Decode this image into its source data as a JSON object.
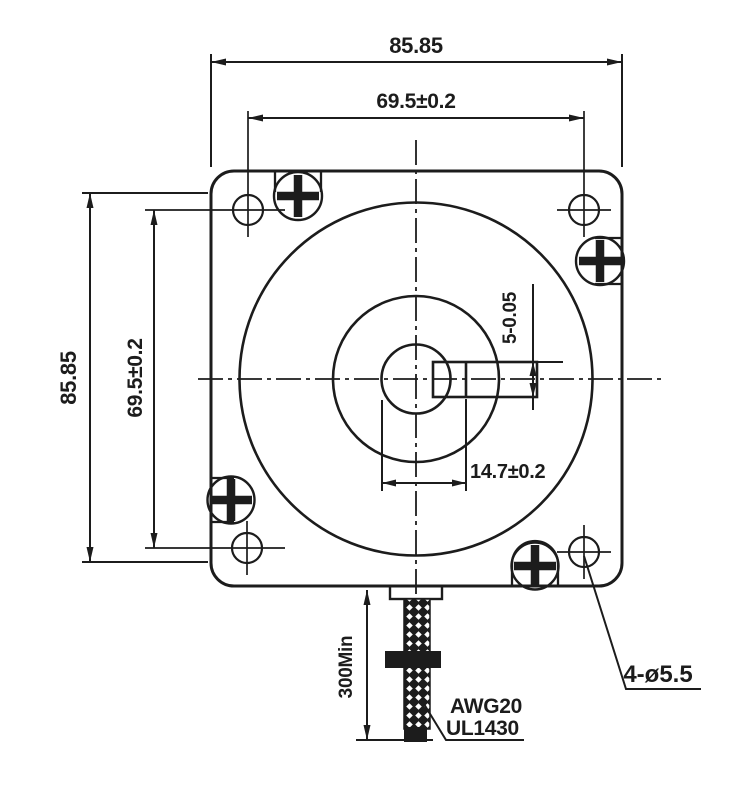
{
  "colors": {
    "line": "#1c1c1c",
    "background": "#ffffff"
  },
  "dimensions": {
    "overall_width": "85.85",
    "bolt_spacing_width": "69.5±0.2",
    "overall_height": "85.85",
    "bolt_spacing_height": "69.5±0.2",
    "shaft_flat_width": "5-0.05",
    "shaft_flat_length": "14.7±0.2",
    "cable_length_min": "300Min",
    "mounting_hole_spec": "4-ø5.5"
  },
  "cable": {
    "wire_gauge": "AWG20",
    "wire_standard": "UL1430"
  }
}
